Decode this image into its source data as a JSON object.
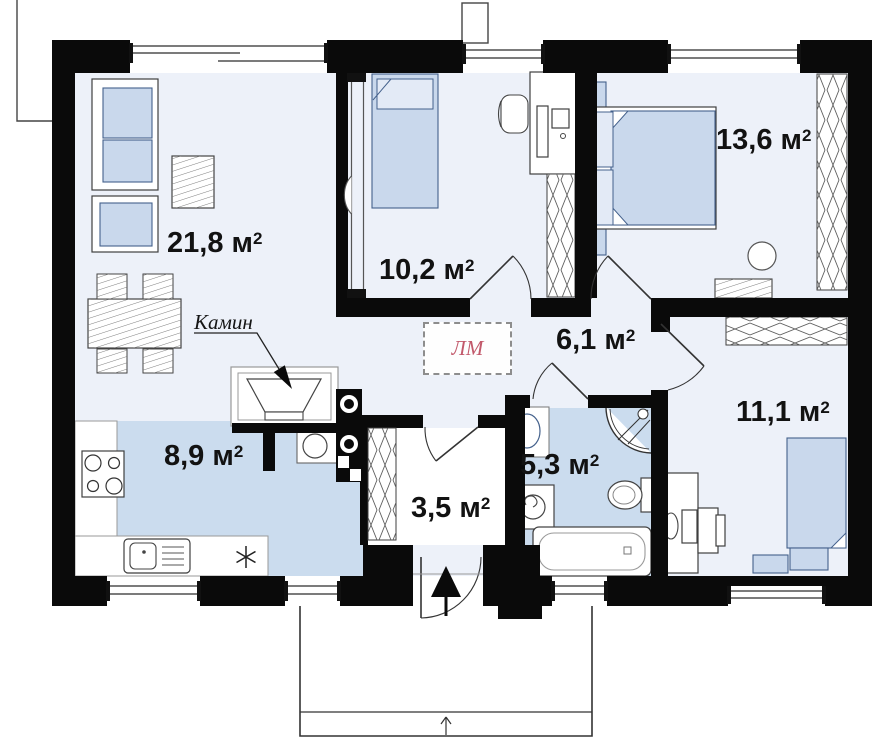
{
  "plan": {
    "title": "floor-plan",
    "rooms": [
      {
        "name": "living-room",
        "area": "21,8",
        "unit": " м",
        "sup": "2"
      },
      {
        "name": "bedroom-top-middle",
        "area": "10,2",
        "unit": " м",
        "sup": "2"
      },
      {
        "name": "bedroom-top-right",
        "area": "13,6",
        "unit": " м",
        "sup": "2"
      },
      {
        "name": "hallway",
        "area": "6,1",
        "unit": " м",
        "sup": "2"
      },
      {
        "name": "bedroom-bottom-right",
        "area": "11,1",
        "unit": " м",
        "sup": "2"
      },
      {
        "name": "bathroom",
        "area": "5,3",
        "unit": " м",
        "sup": "2"
      },
      {
        "name": "kitchen",
        "area": "8,9",
        "unit": " м",
        "sup": "2"
      },
      {
        "name": "entry-corridor",
        "area": "3,5",
        "unit": " м",
        "sup": "2"
      }
    ],
    "annotations": {
      "fireplace": "Камин",
      "lm": "ЛМ"
    },
    "colors": {
      "wall": "#0a0a0a",
      "floor": "#edf1f9",
      "floor-shaded": "#cbdcee",
      "furniture-fill": "#c9d8ec",
      "furniture-fill-light": "#e3eaf6",
      "furniture-stroke": "#44618c",
      "outline": "#3f3f3f",
      "outline-light": "#8a8a8a",
      "label": "#121212",
      "lm": "#c2596b"
    }
  }
}
